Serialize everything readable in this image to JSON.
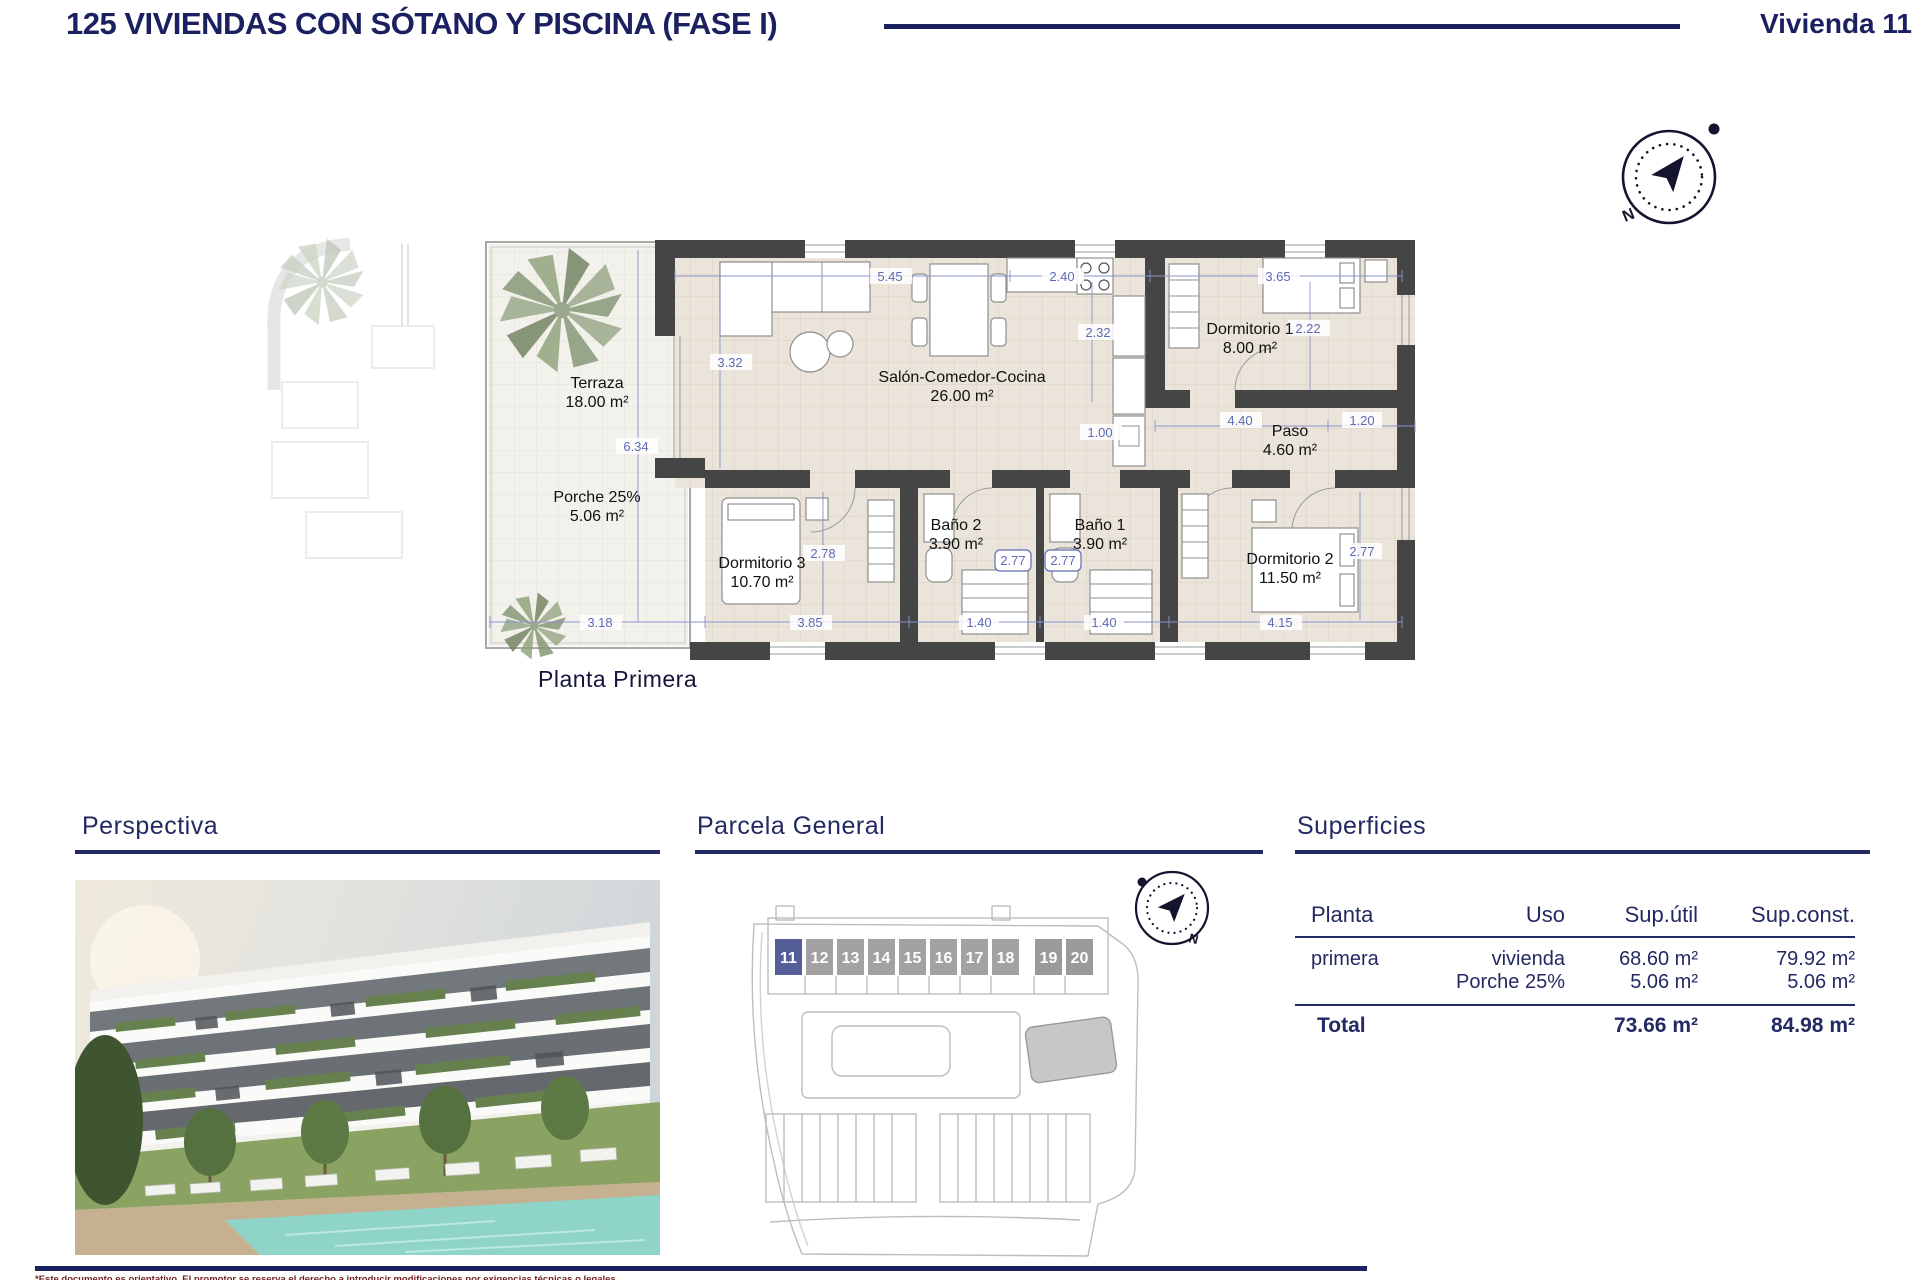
{
  "header": {
    "title": "125 VIVIENDAS CON SÓTANO Y PISCINA (FASE I)",
    "unit": "Vivienda 11"
  },
  "floor_plan": {
    "caption": "Planta Primera",
    "rooms": {
      "terraza": {
        "name": "Terraza",
        "area": "18.00 m²"
      },
      "porche": {
        "name": "Porche 25%",
        "area": "5.06 m²"
      },
      "salon": {
        "name": "Salón-Comedor-Cocina",
        "area": "26.00 m²"
      },
      "dormitorio1": {
        "name": "Dormitorio 1",
        "area": "8.00 m²"
      },
      "paso": {
        "name": "Paso",
        "area": "4.60 m²"
      },
      "bano2": {
        "name": "Baño 2",
        "area": "3.90 m²"
      },
      "bano1": {
        "name": "Baño 1",
        "area": "3.90 m²"
      },
      "dormitorio3": {
        "name": "Dormitorio 3",
        "area": "10.70 m²"
      },
      "dormitorio2": {
        "name": "Dormitorio 2",
        "area": "11.50 m²"
      }
    },
    "dims": {
      "salon_w": "5.45",
      "kitchen_w": "2.40",
      "dorm1_w": "3.65",
      "salon_h": "3.32",
      "kitchen_h": "2.32",
      "dorm1_h": "2.22",
      "terraza_h": "6.34",
      "opening": "1.00",
      "paso_w": "4.40",
      "paso_end": "1.20",
      "dorm3_h": "2.78",
      "bano2_door": "2.77",
      "bano1_door": "2.77",
      "dorm2_h": "2.77",
      "terraza_w": "3.18",
      "dorm3_w": "3.85",
      "bano2_w": "1.40",
      "bano1_w": "1.40",
      "dorm2_w": "4.15"
    }
  },
  "sections": {
    "perspective_title": "Perspectiva",
    "parcel_title": "Parcela General",
    "surfaces_title": "Superficies"
  },
  "parcel": {
    "units": [
      "11",
      "12",
      "13",
      "14",
      "15",
      "16",
      "17",
      "18",
      "19",
      "20"
    ],
    "highlighted_unit": "11"
  },
  "surfaces_table": {
    "headers": [
      "Planta",
      "Uso",
      "Sup.útil",
      "Sup.const."
    ],
    "rows": [
      {
        "planta": "primera",
        "uso": "vivienda",
        "sup_util": "68.60 m²",
        "sup_const": "79.92 m²"
      },
      {
        "planta": "",
        "uso": "Porche 25%",
        "sup_util": "5.06 m²",
        "sup_const": "5.06 m²"
      }
    ],
    "total": {
      "label": "Total",
      "sup_util": "73.66 m²",
      "sup_const": "84.98 m²"
    }
  },
  "compass": {
    "north_label": "N"
  },
  "footer": {
    "disclaimer": "*Este documento es orientativo. El promotor se reserva el derecho a introducir modificaciones por exigencias técnicas o legales."
  },
  "colors": {
    "navy": "#1b2160",
    "dim_blue": "#5d6ab5",
    "wall_gray": "#454545",
    "highlight_unit": "#555e96",
    "pool": "#8fd4c8"
  }
}
